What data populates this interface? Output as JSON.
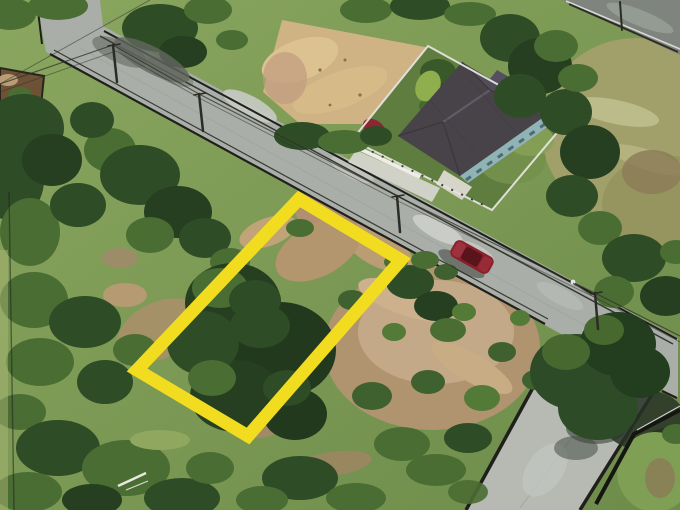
{
  "scene": {
    "description": "Aerial drone photo of a vacant land plot marked with a thick yellow boundary rectangle beside a rural road; a single house with dark hip roof and white fence sits across the road next to a sandy lot; a dark red car travels on the road; a concrete side road with black drains branches to the bottom right.",
    "colors": {
      "grass_top": "#8aa65f",
      "grass_bottom": "#6d8c4a",
      "grass_light": "#9db066",
      "bush_dark": "#2e4c26",
      "bush_darker": "#253f20",
      "bush_mid": "#4a6d33",
      "dirt_field": "#b09470",
      "dirt_light": "#c3a987",
      "sand": "#cfb384",
      "soil_dark": "#6e5236",
      "road": "#a9aea9",
      "road_bright": "#c9ccc7",
      "road_dark": "#7f857e",
      "concrete": "#b6bab3",
      "edge_dark": "#1f1f1b",
      "fence_white": "#e4e4de",
      "roof_dark": "#474349",
      "roof_light": "#524d57",
      "wall_teal": "#8fb3b6",
      "porch": "#d7d4ca",
      "canopy_red": "#8c2630",
      "car_body": "#8a2029",
      "car_glass": "#5a141c",
      "boundary_yellow": "#f2dc20",
      "wire": "#30302a"
    }
  }
}
